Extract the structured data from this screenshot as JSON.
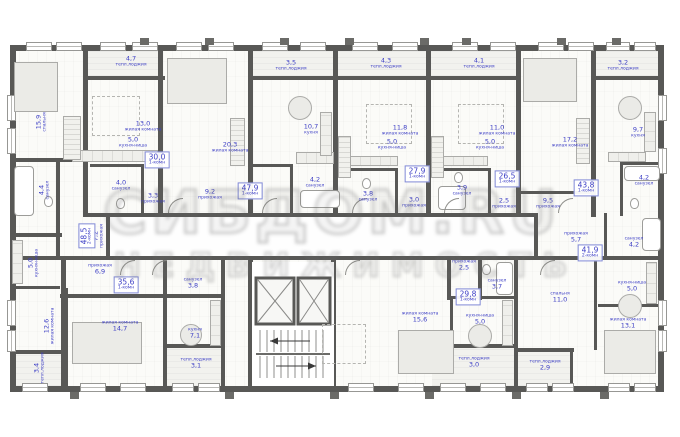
{
  "watermark": {
    "line1": "СИБДОМ.RU",
    "line2": "НЕДВИЖИМОСТЬ"
  },
  "colors": {
    "label_blue": "#3c3ec5",
    "wall_gray": "#585856",
    "badge_border": "#8089d6"
  },
  "rooms": [
    {
      "id": "r1",
      "name": "спальня",
      "area": "15,9"
    },
    {
      "id": "r2",
      "name": "тепл.лоджия",
      "area": "4,7"
    },
    {
      "id": "r3",
      "name": "жилая комната",
      "area": "13,0"
    },
    {
      "id": "r4",
      "name": "кухня-ниша",
      "area": "5,0"
    },
    {
      "id": "r5",
      "name": "санузел",
      "area": "4,4"
    },
    {
      "id": "r6",
      "name": "кухня-ниша",
      "area": "5,0"
    },
    {
      "id": "r7",
      "name": "жилая комната",
      "area": "12,6"
    },
    {
      "id": "r8",
      "name": "тепл.лоджия",
      "area": "3,4"
    },
    {
      "id": "r9",
      "name": "прихожая",
      "area": "7,2"
    },
    {
      "id": "r10",
      "name": "санузел",
      "area": "4,0"
    },
    {
      "id": "r11",
      "name": "прихожая",
      "area": "3,3"
    },
    {
      "id": "r12",
      "name": "тепл.лоджия",
      "area": "3,5"
    },
    {
      "id": "r13",
      "name": "жилая комната",
      "area": "20,3"
    },
    {
      "id": "r14",
      "name": "кухня",
      "area": "10,7"
    },
    {
      "id": "r15",
      "name": "санузел",
      "area": "4,2"
    },
    {
      "id": "r16",
      "name": "прихожая",
      "area": "9,2"
    },
    {
      "id": "r17",
      "name": "тепл.лоджия",
      "area": "4,3"
    },
    {
      "id": "r18",
      "name": "жилая комната",
      "area": "11,8"
    },
    {
      "id": "r19",
      "name": "кухня-ниша",
      "area": "5,0"
    },
    {
      "id": "r20",
      "name": "санузел",
      "area": "3,8"
    },
    {
      "id": "r21",
      "name": "прихожая",
      "area": "3,0"
    },
    {
      "id": "r22",
      "name": "тепл.лоджия",
      "area": "4,1"
    },
    {
      "id": "r23",
      "name": "жилая комната",
      "area": "11,0"
    },
    {
      "id": "r24",
      "name": "кухня-ниша",
      "area": "5,0"
    },
    {
      "id": "r25",
      "name": "санузел",
      "area": "3,9"
    },
    {
      "id": "r26",
      "name": "прихожая",
      "area": "2,5"
    },
    {
      "id": "r27",
      "name": "тепл.лоджия",
      "area": "3,2"
    },
    {
      "id": "r28",
      "name": "жилая комната",
      "area": "17,2"
    },
    {
      "id": "r29",
      "name": "кухня",
      "area": "9,7"
    },
    {
      "id": "r30",
      "name": "санузел",
      "area": "4,2"
    },
    {
      "id": "r31",
      "name": "прихожая",
      "area": "9,5"
    },
    {
      "id": "r32",
      "name": "прихожая",
      "area": "6,9"
    },
    {
      "id": "r33",
      "name": "жилая комната",
      "area": "14,7"
    },
    {
      "id": "r34",
      "name": "санузел",
      "area": "3,8"
    },
    {
      "id": "r35",
      "name": "кухня",
      "area": "7,1"
    },
    {
      "id": "r36",
      "name": "тепл.лоджия",
      "area": "3,1"
    },
    {
      "id": "r37",
      "name": "прихожая",
      "area": "2,5"
    },
    {
      "id": "r38",
      "name": "санузел",
      "area": "3,7"
    },
    {
      "id": "r39",
      "name": "жилая комната",
      "area": "15,6"
    },
    {
      "id": "r40",
      "name": "кухня-ниша",
      "area": "5,0"
    },
    {
      "id": "r41",
      "name": "тепл.лоджия",
      "area": "3,0"
    },
    {
      "id": "r42",
      "name": "прихожая",
      "area": "5,7"
    },
    {
      "id": "r43",
      "name": "санузел",
      "area": "4,2"
    },
    {
      "id": "r44",
      "name": "спальня",
      "area": "11,0"
    },
    {
      "id": "r45",
      "name": "кухня-ниша",
      "area": "5,0"
    },
    {
      "id": "r46",
      "name": "жилая комната",
      "area": "13,1"
    },
    {
      "id": "r47",
      "name": "тепл.лоджия",
      "area": "2,9"
    }
  ],
  "apartments": [
    {
      "id": "a1",
      "type": "2-комн",
      "area": "48,5"
    },
    {
      "id": "a2",
      "type": "1-комн",
      "area": "30,0"
    },
    {
      "id": "a3",
      "type": "1-комн",
      "area": "47,9"
    },
    {
      "id": "a4",
      "type": "1-комн",
      "area": "27,9"
    },
    {
      "id": "a5",
      "type": "1-комн",
      "area": "26,5"
    },
    {
      "id": "a6",
      "type": "1-комн",
      "area": "43,8"
    },
    {
      "id": "a7",
      "type": "1-комн",
      "area": "35,6"
    },
    {
      "id": "a8",
      "type": "1-комн",
      "area": "29,8"
    },
    {
      "id": "a9",
      "type": "2-комн",
      "area": "41,9"
    }
  ],
  "core": {
    "elevators": 2,
    "stairs": 1
  }
}
